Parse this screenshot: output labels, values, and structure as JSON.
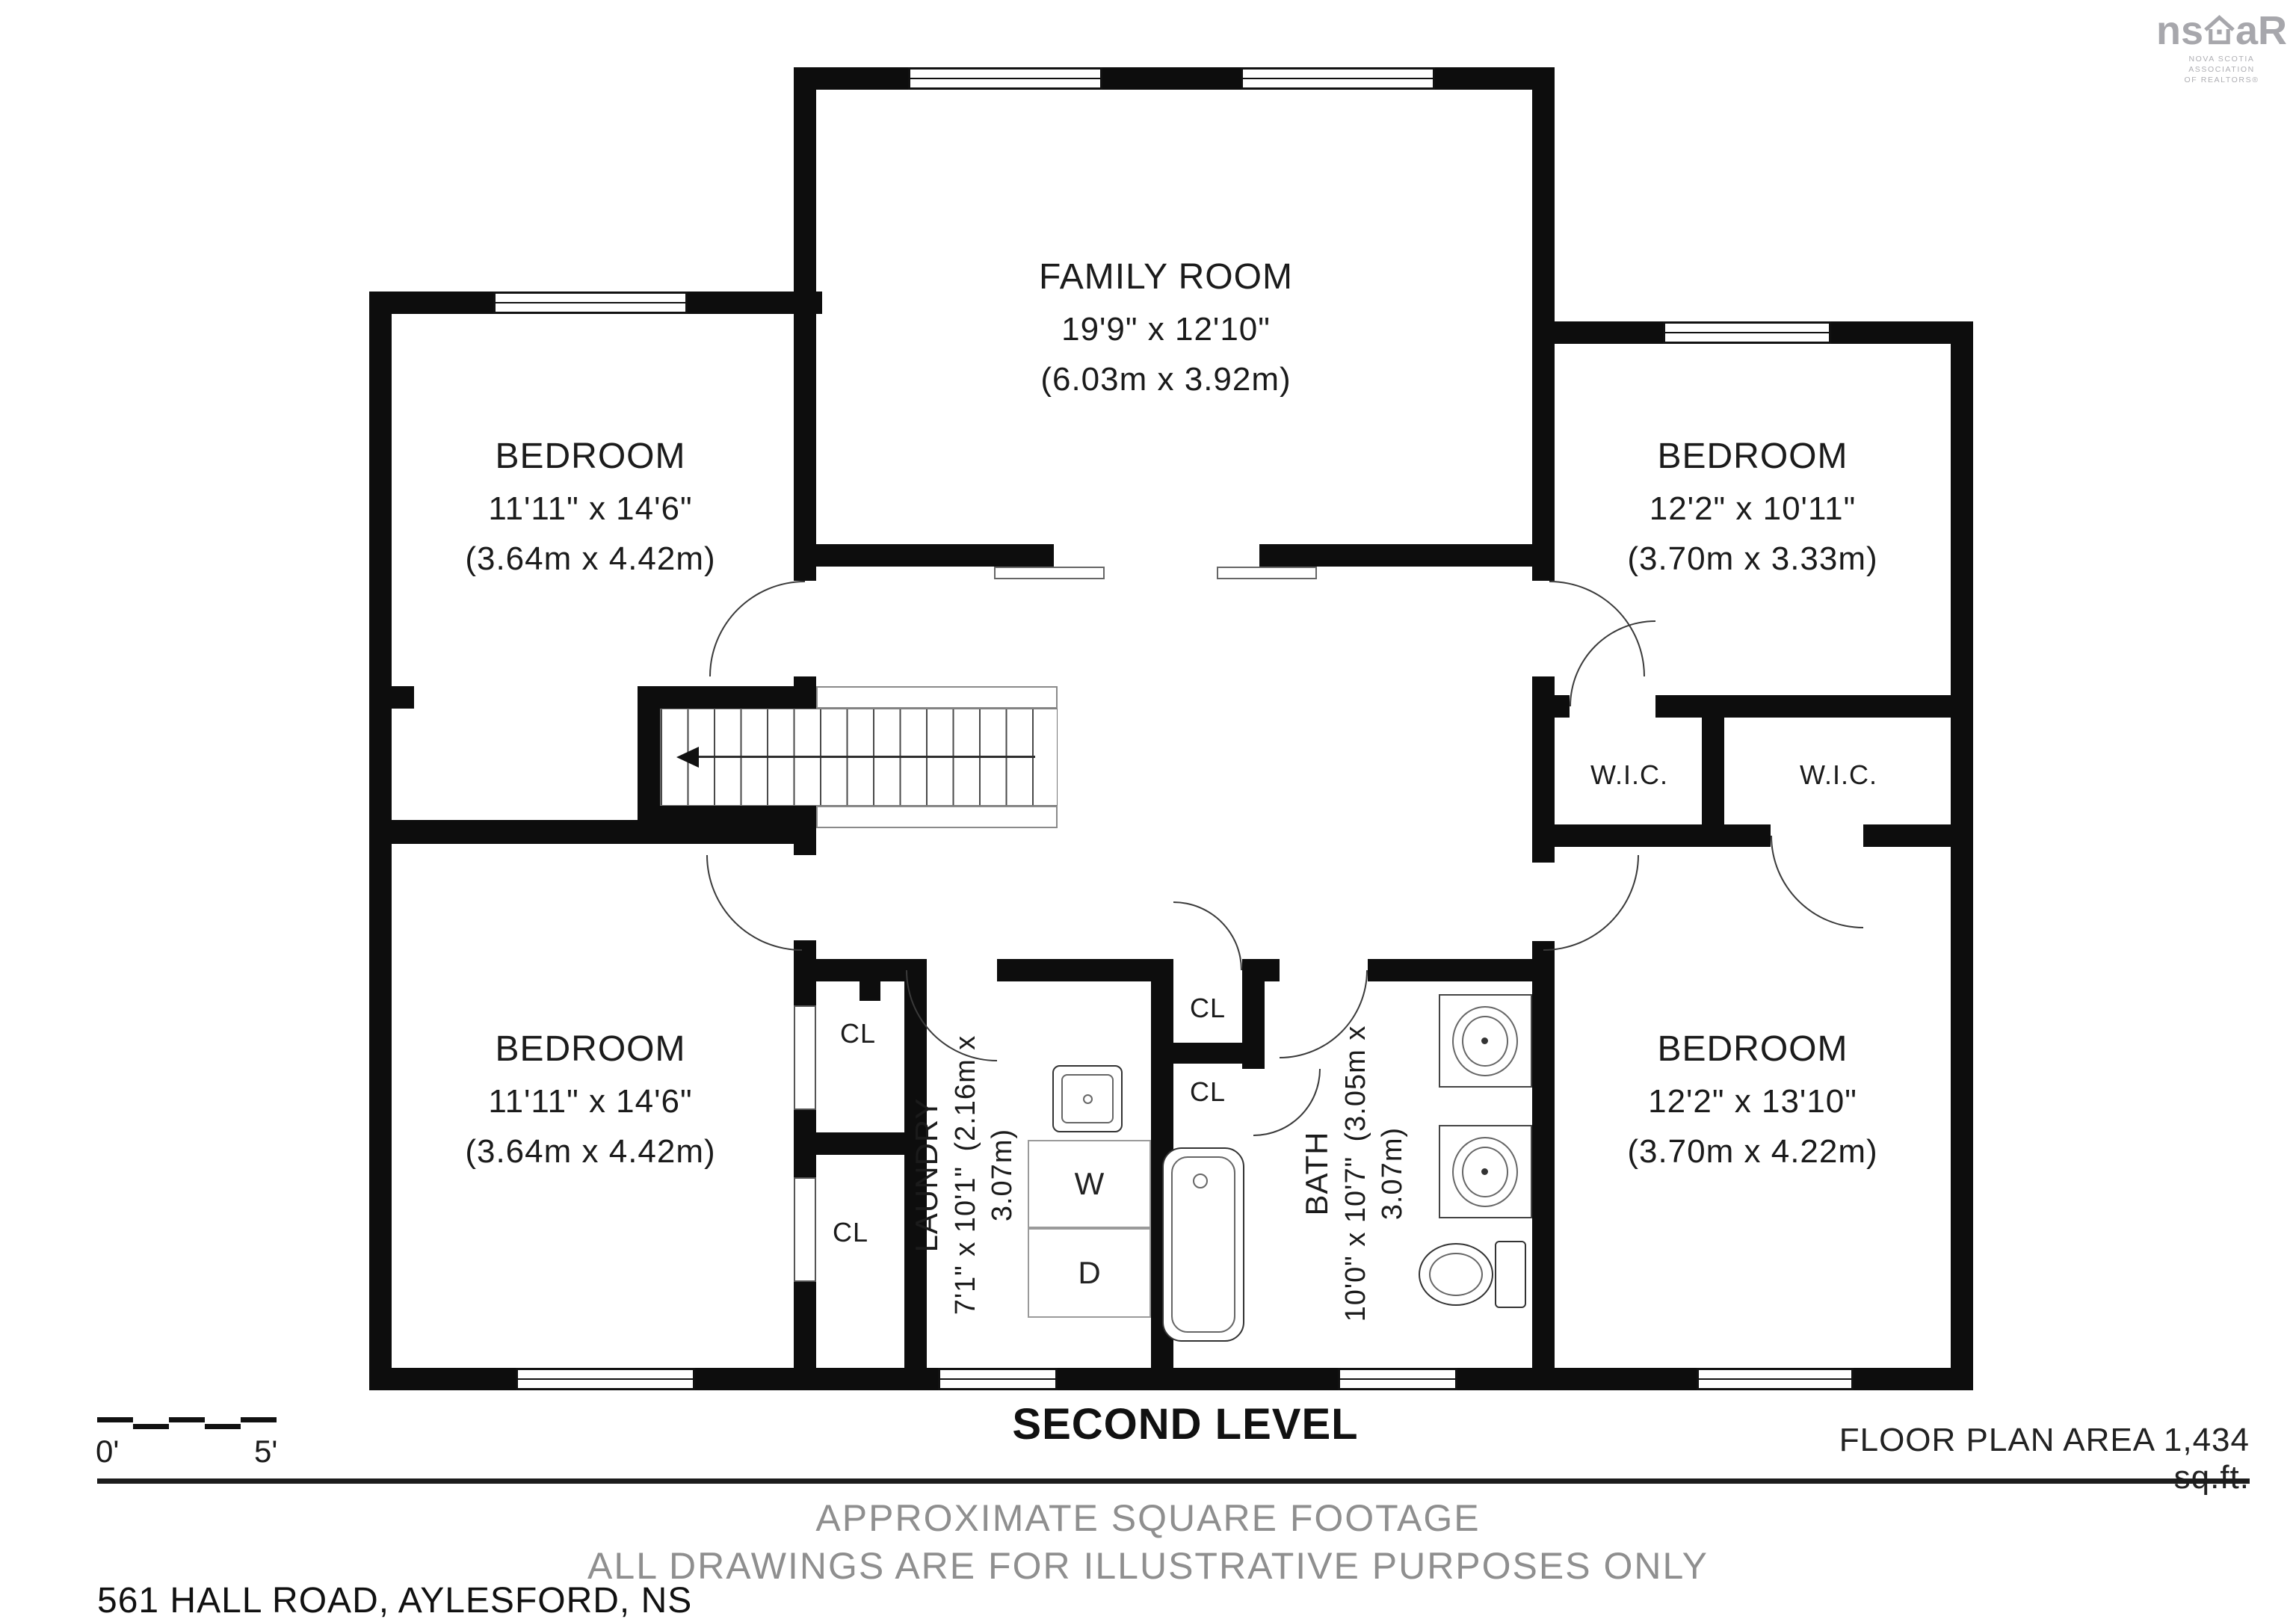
{
  "logo": {
    "brand_left": "ns",
    "brand_right": "aR",
    "sub_line1": "NOVA SCOTIA ASSOCIATION",
    "sub_line2": "OF REALTORS®"
  },
  "rooms": {
    "family": {
      "name": "FAMILY ROOM",
      "imperial": "19'9\" x 12'10\"",
      "metric": "(6.03m x 3.92m)"
    },
    "bedroom_top_left": {
      "name": "BEDROOM",
      "imperial": "11'11\" x 14'6\"",
      "metric": "(3.64m x 4.42m)"
    },
    "bedroom_top_right": {
      "name": "BEDROOM",
      "imperial": "12'2\" x 10'11\"",
      "metric": "(3.70m x 3.33m)"
    },
    "bedroom_bottom_left": {
      "name": "BEDROOM",
      "imperial": "11'11\" x 14'6\"",
      "metric": "(3.64m x 4.42m)"
    },
    "bedroom_bottom_right": {
      "name": "BEDROOM",
      "imperial": "12'2\" x 13'10\"",
      "metric": "(3.70m x 4.22m)"
    },
    "laundry": {
      "name": "LAUNDRY",
      "imperial": "7'1\" x 10'1\"",
      "metric": "(2.16m x 3.07m)"
    },
    "bath": {
      "name": "BATH",
      "imperial": "10'0\" x 10'7\"",
      "metric": "(3.05m x 3.07m)"
    }
  },
  "labels": {
    "walk_in_closet": "W.I.C.",
    "closet": "CL",
    "washer": "W",
    "dryer": "D"
  },
  "footer": {
    "level_title": "SECOND LEVEL",
    "floor_area": "FLOOR PLAN AREA 1,434 sq.ft.",
    "note_line1": "APPROXIMATE SQUARE FOOTAGE",
    "note_line2": "ALL DRAWINGS ARE FOR ILLUSTRATIVE PURPOSES ONLY",
    "address": "561 HALL ROAD, AYLESFORD, NS",
    "scale_start": "0'",
    "scale_end": "5'"
  }
}
